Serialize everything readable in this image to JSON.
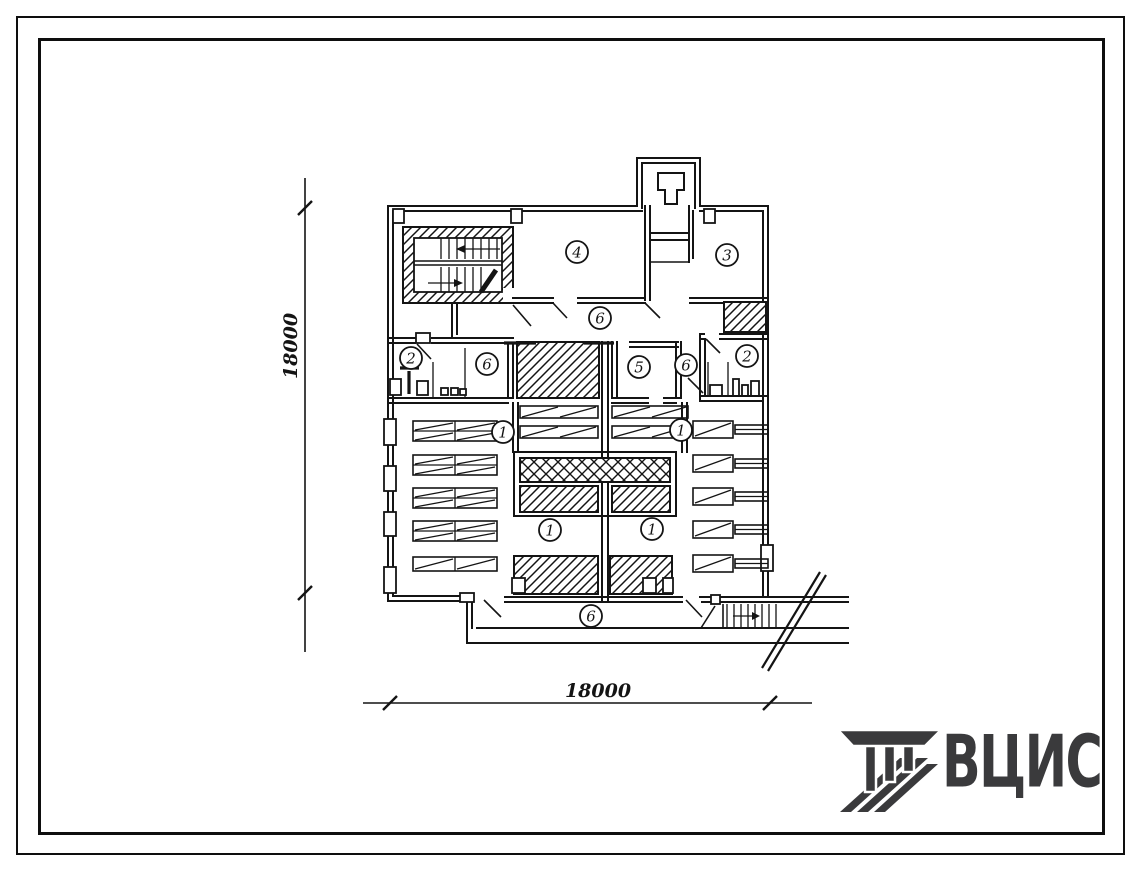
{
  "document": {
    "kind": "scanned typical-design floor plan sheet",
    "background": "#ffffff",
    "ink": "#141414"
  },
  "dimensions": {
    "vertical": "18000",
    "horizontal": "18000"
  },
  "plan": {
    "room_labels": [
      "2",
      "6",
      "4",
      "3",
      "6",
      "5",
      "6",
      "2",
      "1",
      "1",
      "1",
      "1",
      "6"
    ]
  },
  "logo": {
    "text": "ВЦИС",
    "color": "#3a3a3c"
  }
}
